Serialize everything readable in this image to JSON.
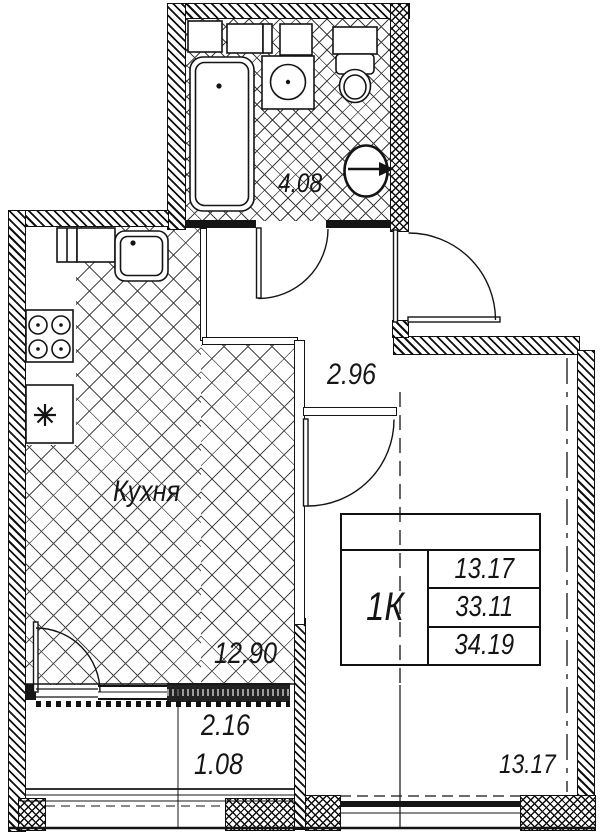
{
  "plan": {
    "stamp": {
      "apartment_type": "1К",
      "living_area": "13.17",
      "area": "33.11",
      "total_area": "34.19"
    },
    "labels": {
      "bathroom_area": "4.08",
      "hallway_area": "2.96",
      "kitchen_name": "Кухня",
      "kitchen_area": "12.90",
      "room_area": "13.17",
      "balcony_area": "2.16",
      "balcony_area_reduced": "1.08"
    },
    "colors": {
      "line": "#141414",
      "paper": "#ffffff"
    }
  }
}
